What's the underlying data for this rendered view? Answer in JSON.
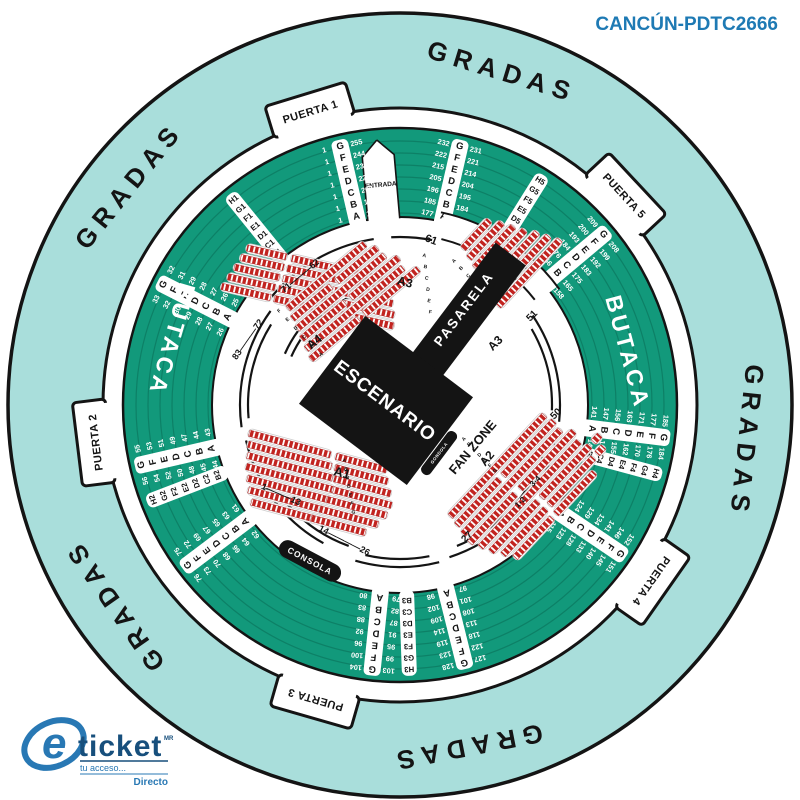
{
  "header": {
    "venue_code": "CANCÚN-PDTC2666"
  },
  "logo": {
    "monogram": "e",
    "brand": "ticket",
    "tm": "MR",
    "tagline": "tu acceso...",
    "sub_brand": "Directo"
  },
  "colors": {
    "teal_ring": "#a9dedb",
    "green": "#12997b",
    "green_line": "#0a6b55",
    "black": "#141414",
    "seat_red": "#c2231f",
    "header_blue": "#1e7ab4",
    "logo_blue": "#2878b4",
    "logo_dark": "#174f7c",
    "white": "#ffffff"
  },
  "gradas": {
    "label": "GRADAS",
    "positions": [
      {
        "theta": -51
      },
      {
        "theta": 17
      },
      {
        "theta": 96
      },
      {
        "theta": 169
      },
      {
        "theta": -125
      }
    ]
  },
  "gates": [
    {
      "label": "PUERTA 1",
      "theta": -17
    },
    {
      "label": "PUERTA 2",
      "theta": -97
    },
    {
      "label": "PUERTA 3",
      "theta": 196
    },
    {
      "label": "PUERTA 4",
      "theta": 125
    },
    {
      "label": "PUERTA 5",
      "theta": 47
    }
  ],
  "entrance": {
    "label": "ENTRADA",
    "theta": -5
  },
  "butaca_ring": {
    "row_letters": [
      "G",
      "F",
      "E",
      "D",
      "C",
      "B",
      "A"
    ],
    "label_left": {
      "text": "BUTACA",
      "r": 245,
      "theta": -74,
      "rot": 106
    },
    "label_right": {
      "text": "BUTACA",
      "r": 226,
      "theta": 77,
      "rot": 75
    },
    "dividers": [
      {
        "theta": -13,
        "a": [
          "1",
          "1",
          "1",
          "1",
          "1",
          "1",
          "1"
        ],
        "b": [
          "255",
          "244",
          "236",
          "225",
          "207",
          "196",
          "187"
        ]
      },
      {
        "theta": 13,
        "a": [
          "232",
          "222",
          "215",
          "205",
          "196",
          "185",
          "177"
        ],
        "b": [
          "231",
          "221",
          "214",
          "204",
          "195",
          "184",
          "176"
        ]
      },
      {
        "theta": 50,
        "a": [
          "209",
          "200",
          "193",
          "184",
          "176",
          "166",
          "159"
        ],
        "b": [
          "208",
          "199",
          "192",
          "183",
          "175",
          "165",
          "158"
        ]
      },
      {
        "theta": 97,
        "a": [
          "185",
          "177",
          "171",
          "163",
          "156",
          "147",
          "141"
        ],
        "b": [
          "184",
          "176",
          "170",
          "162",
          "155",
          "146",
          "140"
        ]
      },
      {
        "theta": 124,
        "a": [
          "152",
          "146",
          "141",
          "134",
          "129",
          "124",
          "116"
        ],
        "b": [
          "151",
          "145",
          "140",
          "133",
          "128",
          "123",
          "115"
        ]
      },
      {
        "theta": 166,
        "a": [
          "127",
          "122",
          "118",
          "113",
          "108",
          "101",
          "97"
        ],
        "b": [
          "128",
          "123",
          "119",
          "114",
          "109",
          "102",
          "98"
        ]
      },
      {
        "theta": 186,
        "a": [
          "103",
          "99",
          "95",
          "91",
          "87",
          "82",
          "79"
        ],
        "b": [
          "104",
          "100",
          "96",
          "92",
          "88",
          "83",
          "80"
        ]
      },
      {
        "theta": -127,
        "a": [
          "76",
          "73",
          "70",
          "68",
          "66",
          "64",
          "62"
        ],
        "b": [
          "75",
          "72",
          "69",
          "67",
          "65",
          "63",
          "61"
        ]
      },
      {
        "theta": -103,
        "a": [
          "56",
          "54",
          "52",
          "50",
          "48",
          "45",
          "44"
        ],
        "b": [
          "55",
          "53",
          "51",
          "49",
          "47",
          "44",
          "43"
        ]
      },
      {
        "theta": -63,
        "a": [
          "33",
          "32",
          "30",
          "29",
          "28",
          "27",
          "26"
        ],
        "b": [
          "32",
          "31",
          "29",
          "28",
          "27",
          "26",
          "25"
        ]
      }
    ],
    "strips": [
      {
        "theta": -39,
        "codes": [
          "B1",
          "C1",
          "D1",
          "E1",
          "F1",
          "G1",
          "H1"
        ]
      },
      {
        "theta": 32,
        "codes": [
          "B5",
          "C5",
          "D5",
          "E5",
          "F5",
          "G5",
          "H5"
        ]
      },
      {
        "theta": 105,
        "codes": [
          "B4",
          "C4",
          "D4",
          "E4",
          "F4",
          "G4",
          "H4"
        ]
      },
      {
        "theta": 178,
        "codes": [
          "B3",
          "C3",
          "D3",
          "E3",
          "F3",
          "G3",
          "H3"
        ]
      },
      {
        "theta": -111,
        "codes": [
          "B2",
          "C2",
          "D2",
          "E2",
          "F2",
          "G2",
          "H2"
        ]
      }
    ]
  },
  "inner_ring": {
    "toriles": "TORILES",
    "consola": "CONSOLA"
  },
  "stage": {
    "label": "ESCENARIO",
    "pasarela": "PASARELA",
    "gondola": "GONDOLA"
  },
  "floor": {
    "labels": [
      {
        "text": "61",
        "x": 430,
        "y": 243,
        "rot": 20,
        "size": 11
      },
      {
        "text": "71———62",
        "x": 302,
        "y": 278,
        "rot": -40,
        "size": 9
      },
      {
        "text": "83———72",
        "x": 250,
        "y": 341,
        "rot": -55,
        "size": 9
      },
      {
        "text": "1———13",
        "x": 280,
        "y": 497,
        "rot": 24,
        "size": 9
      },
      {
        "text": "14————26",
        "x": 343,
        "y": 543,
        "rot": 27,
        "size": 9
      },
      {
        "text": "27",
        "x": 469,
        "y": 539,
        "rot": -45,
        "size": 10
      },
      {
        "text": "50",
        "x": 558,
        "y": 416,
        "rot": -45,
        "size": 10
      },
      {
        "text": "51",
        "x": 534,
        "y": 318,
        "rot": -45,
        "size": 10
      },
      {
        "text": "1-2",
        "x": 522,
        "y": 504,
        "rot": -45,
        "size": 8
      },
      {
        "text": "3-4",
        "x": 537,
        "y": 483,
        "rot": -45,
        "size": 8
      },
      {
        "text": "A1",
        "x": 341,
        "y": 477,
        "rot": 14,
        "size": 13
      },
      {
        "text": "A2",
        "x": 490,
        "y": 461,
        "rot": -50,
        "size": 12
      },
      {
        "text": "FAN ZONE",
        "x": 476,
        "y": 450,
        "rot": -50,
        "size": 13
      },
      {
        "text": "A3",
        "x": 404,
        "y": 286,
        "rot": 14,
        "size": 12
      },
      {
        "text": "A3",
        "x": 498,
        "y": 346,
        "rot": -45,
        "size": 12
      },
      {
        "text": "A4",
        "x": 317,
        "y": 345,
        "rot": -40,
        "size": 12
      }
    ],
    "letter_cols": [
      {
        "letters": [
          "A",
          "B",
          "C",
          "D",
          "E",
          "F"
        ],
        "x": 424,
        "y": 257,
        "dx": 1.2,
        "dy": 11.3,
        "rot": 12
      },
      {
        "letters": [
          "A",
          "B",
          "C",
          "D",
          "E",
          "F"
        ],
        "x": 455,
        "y": 262,
        "dx": 7.2,
        "dy": 7.4,
        "rot": -45
      },
      {
        "letters": [
          "F",
          "E",
          "D",
          "C",
          "B",
          "A"
        ],
        "x": 280,
        "y": 312,
        "dx": 8.4,
        "dy": 8.7,
        "rot": -40
      },
      {
        "letters": [
          "A",
          "B",
          "C",
          "D",
          "E",
          "F",
          "G"
        ],
        "x": 344,
        "y": 462,
        "dx": 1.5,
        "dy": 8.6,
        "rot": 14
      },
      {
        "letters": [
          "A",
          "B",
          "C",
          "D",
          "E",
          "F",
          "G"
        ],
        "x": 465,
        "y": 440,
        "dx": 5.2,
        "dy": 5.3,
        "rot": -47
      }
    ]
  }
}
